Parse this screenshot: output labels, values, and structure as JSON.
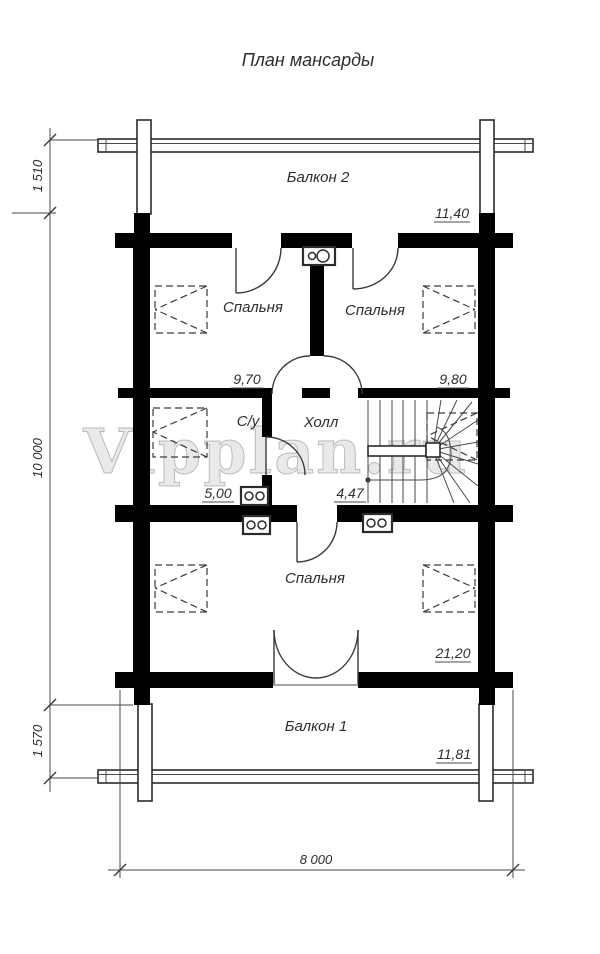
{
  "title": "План мансарды",
  "watermark": "Vipplan.ru",
  "rooms": {
    "balcony2": {
      "name": "Балкон 2",
      "area": "11,40"
    },
    "bedroom_top_left": {
      "name": "Спальня",
      "area": "9,70"
    },
    "bedroom_top_right": {
      "name": "Спальня",
      "area": "9,80"
    },
    "bathroom": {
      "name": "С/у",
      "area": "5,00"
    },
    "hall": {
      "name": "Холл",
      "area": "4,47"
    },
    "bedroom_bottom": {
      "name": "Спальня",
      "area": "21,20"
    },
    "balcony1": {
      "name": "Балкон 1",
      "area": "11,81"
    }
  },
  "dimensions": {
    "balcony2_depth": "1 510",
    "house_length": "10 000",
    "balcony1_depth": "1 570",
    "house_width": "8 000"
  },
  "colors": {
    "walls": "#000000",
    "lines": "#3a3a3a",
    "watermark_gray": "#afafaf",
    "background": "#ffffff"
  }
}
